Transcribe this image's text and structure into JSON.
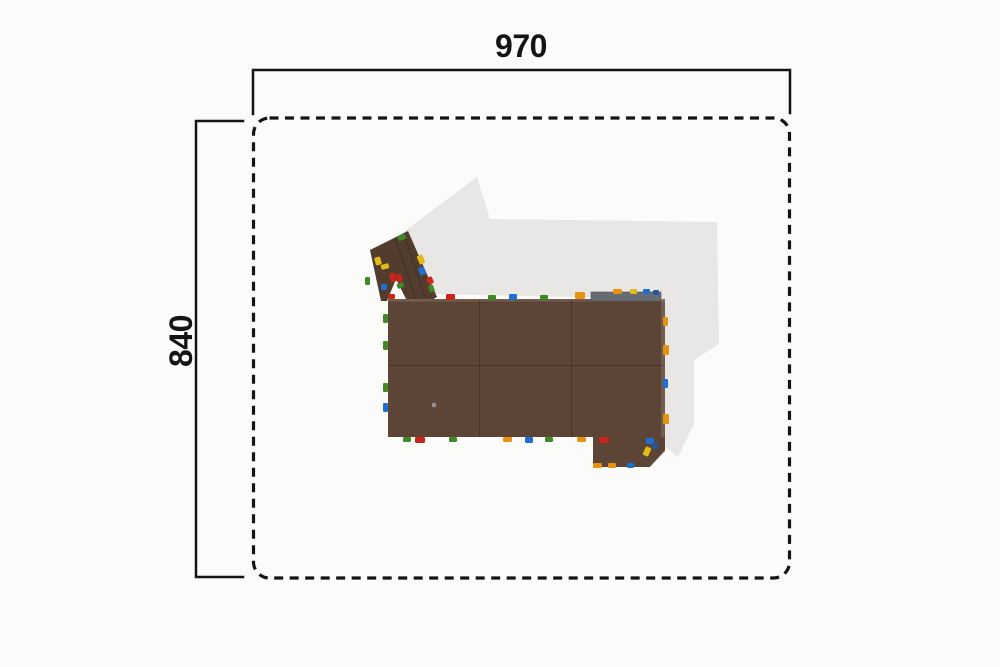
{
  "dimensions": {
    "width_label": "970",
    "height_label": "840"
  },
  "colors": {
    "line": "#141414",
    "background": "#fbfbfa",
    "shadow": "#e8e7e5",
    "wood": "#5c4536",
    "wood_dark": "#523c2e",
    "platform": "#666c71",
    "red": "#c9251b",
    "green": "#3f8a26",
    "blue": "#1d6fd2",
    "orange": "#e6930f",
    "yellow": "#e2bc13",
    "navy": "#27569c"
  },
  "structure": {
    "shadow_points": "477,177 490,219 717,222 719,344 694,360 694,424 678,457 664,446 664,299 430,294 402,233",
    "arm_points": "370,250 408,231 437,297 430,301 381,301",
    "notch_points": "387,301 396,279 407,301",
    "extension_points": "593,437 665,437 665,451 650,467 593,467",
    "deck": {
      "x": 388,
      "y": 299,
      "w": 277,
      "h": 138
    },
    "platform": {
      "x": 591,
      "y": 292,
      "w": 70,
      "h": 9
    },
    "seams": [
      {
        "x1": 479.5,
        "y1": 300,
        "x2": 479.5,
        "y2": 437
      },
      {
        "x1": 571.5,
        "y1": 300,
        "x2": 571.5,
        "y2": 437
      },
      {
        "x1": 388,
        "y1": 365.5,
        "x2": 665,
        "y2": 365.5
      },
      {
        "x1": 395,
        "y1": 238,
        "x2": 416,
        "y2": 299
      },
      {
        "x1": 404,
        "y1": 234,
        "x2": 425,
        "y2": 297
      }
    ],
    "holds": [
      {
        "x": 398,
        "y": 235,
        "w": 8,
        "h": 5,
        "c": "green",
        "rot": -22
      },
      {
        "x": 375,
        "y": 257,
        "w": 6,
        "h": 8,
        "c": "yellow",
        "rot": -15
      },
      {
        "x": 381,
        "y": 264,
        "w": 8,
        "h": 5,
        "c": "yellow",
        "rot": -15
      },
      {
        "x": 390,
        "y": 273,
        "w": 6,
        "h": 9,
        "c": "red",
        "rot": -15
      },
      {
        "x": 397,
        "y": 274,
        "w": 5,
        "h": 8,
        "c": "red",
        "rot": -15
      },
      {
        "x": 381,
        "y": 284,
        "w": 6,
        "h": 6,
        "c": "blue",
        "rot": 0
      },
      {
        "x": 397,
        "y": 283,
        "w": 7,
        "h": 5,
        "c": "green",
        "rot": -20
      },
      {
        "x": 365,
        "y": 277,
        "w": 5,
        "h": 8,
        "c": "green",
        "rot": 0
      },
      {
        "x": 418,
        "y": 255,
        "w": 6,
        "h": 9,
        "c": "yellow",
        "rot": -22
      },
      {
        "x": 419,
        "y": 267,
        "w": 6,
        "h": 8,
        "c": "blue",
        "rot": -22
      },
      {
        "x": 427,
        "y": 277,
        "w": 6,
        "h": 7,
        "c": "red",
        "rot": -22
      },
      {
        "x": 429,
        "y": 285,
        "w": 5,
        "h": 7,
        "c": "green",
        "rot": -22
      },
      {
        "x": 446,
        "y": 294,
        "w": 9,
        "h": 6,
        "c": "red",
        "rot": 0
      },
      {
        "x": 488,
        "y": 295,
        "w": 8,
        "h": 5,
        "c": "green",
        "rot": 0
      },
      {
        "x": 509,
        "y": 294,
        "w": 8,
        "h": 6,
        "c": "blue",
        "rot": 0
      },
      {
        "x": 540,
        "y": 295,
        "w": 8,
        "h": 5,
        "c": "green",
        "rot": 0
      },
      {
        "x": 575,
        "y": 292,
        "w": 10,
        "h": 7,
        "c": "orange",
        "rot": 0
      },
      {
        "x": 613,
        "y": 289,
        "w": 9,
        "h": 5,
        "c": "orange",
        "rot": 0
      },
      {
        "x": 630,
        "y": 289,
        "w": 7,
        "h": 5,
        "c": "yellow",
        "rot": 0
      },
      {
        "x": 643,
        "y": 289,
        "w": 7,
        "h": 5,
        "c": "blue",
        "rot": 0
      },
      {
        "x": 653,
        "y": 290,
        "w": 6,
        "h": 5,
        "c": "navy",
        "rot": 0
      },
      {
        "x": 388,
        "y": 294,
        "w": 7,
        "h": 5,
        "c": "red",
        "rot": 0
      },
      {
        "x": 383,
        "y": 314,
        "w": 5,
        "h": 9,
        "c": "green",
        "rot": 0
      },
      {
        "x": 383,
        "y": 341,
        "w": 5,
        "h": 9,
        "c": "green",
        "rot": 0
      },
      {
        "x": 383,
        "y": 383,
        "w": 5,
        "h": 9,
        "c": "green",
        "rot": 0
      },
      {
        "x": 383,
        "y": 403,
        "w": 5,
        "h": 9,
        "c": "blue",
        "rot": 0
      },
      {
        "x": 663,
        "y": 317,
        "w": 5,
        "h": 9,
        "c": "orange",
        "rot": 0
      },
      {
        "x": 663,
        "y": 345,
        "w": 6,
        "h": 10,
        "c": "orange",
        "rot": 0
      },
      {
        "x": 663,
        "y": 379,
        "w": 5,
        "h": 9,
        "c": "blue",
        "rot": 0
      },
      {
        "x": 663,
        "y": 414,
        "w": 6,
        "h": 10,
        "c": "orange",
        "rot": 0
      },
      {
        "x": 403,
        "y": 437,
        "w": 8,
        "h": 5,
        "c": "green",
        "rot": 0
      },
      {
        "x": 415,
        "y": 437,
        "w": 10,
        "h": 6,
        "c": "red",
        "rot": 0
      },
      {
        "x": 449,
        "y": 437,
        "w": 8,
        "h": 5,
        "c": "green",
        "rot": 0
      },
      {
        "x": 503,
        "y": 437,
        "w": 9,
        "h": 5,
        "c": "orange",
        "rot": 0
      },
      {
        "x": 525,
        "y": 437,
        "w": 8,
        "h": 6,
        "c": "blue",
        "rot": 0
      },
      {
        "x": 545,
        "y": 437,
        "w": 8,
        "h": 5,
        "c": "green",
        "rot": 0
      },
      {
        "x": 577,
        "y": 437,
        "w": 9,
        "h": 5,
        "c": "orange",
        "rot": 0
      },
      {
        "x": 599,
        "y": 437,
        "w": 10,
        "h": 6,
        "c": "red",
        "rot": 0
      },
      {
        "x": 646,
        "y": 438,
        "w": 8,
        "h": 6,
        "c": "blue",
        "rot": 0
      },
      {
        "x": 652,
        "y": 443,
        "w": 6,
        "h": 6,
        "c": "navy",
        "rot": 0
      },
      {
        "x": 644,
        "y": 447,
        "w": 6,
        "h": 9,
        "c": "yellow",
        "rot": 25
      },
      {
        "x": 593,
        "y": 463,
        "w": 9,
        "h": 5,
        "c": "orange",
        "rot": 0
      },
      {
        "x": 608,
        "y": 463,
        "w": 8,
        "h": 5,
        "c": "orange",
        "rot": 0
      },
      {
        "x": 627,
        "y": 463,
        "w": 7,
        "h": 5,
        "c": "blue",
        "rot": 0
      }
    ]
  }
}
